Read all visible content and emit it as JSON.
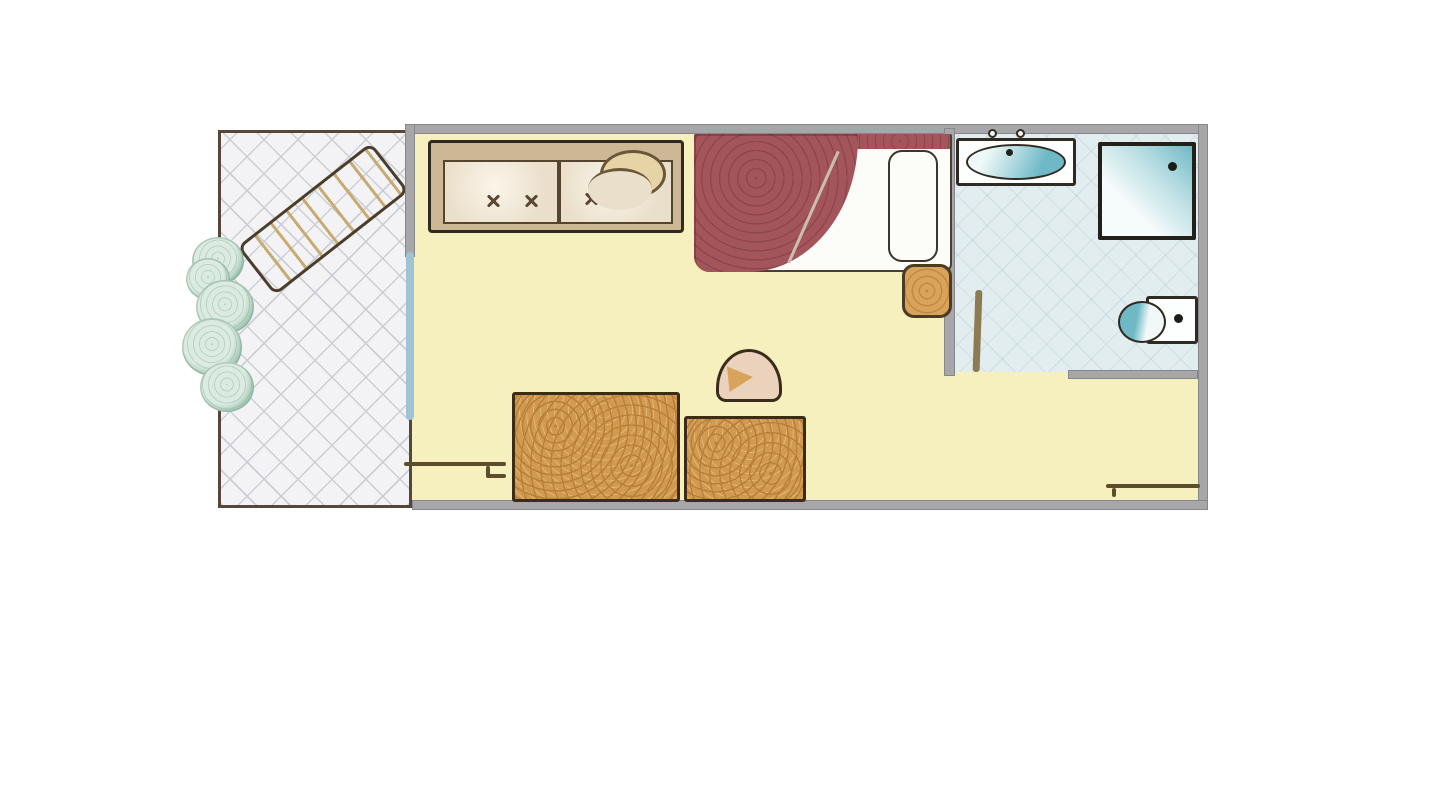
{
  "labels": {
    "plan": "Hotel room floor plan illustration",
    "balcony": "Balcony terrace with tiled floor",
    "lounge_chair": "Sun lounger",
    "plants": "Potted plants along balcony edge",
    "glass_door": "Glass door to balcony",
    "room": "Main room with yellow floor",
    "sofa": "Two-seat sofa with tufted cushions",
    "sofa_throw": "Curved throw pillow on sofa",
    "bed": "Bed with red cover folded back",
    "bed_pillow": "Bed pillow",
    "nightstand": "Wooden nightstand",
    "bathroom": "Bathroom with light blue tiled floor",
    "sink": "Washbasin counter",
    "shower": "Shower enclosure",
    "toilet": "Toilet",
    "bath_door": "Bathroom door leaf",
    "table_large": "Large wooden table",
    "table_small": "Small wooden table",
    "stool": "Stool",
    "wall_top": "Top exterior wall",
    "wall_right": "Right exterior wall",
    "wall_bottom": "Bottom exterior wall",
    "wall_left": "Wall between room and balcony",
    "wall_bath_left": "Wall between bedroom and bathroom",
    "wall_bath_bottom": "Bathroom bottom wall",
    "threshold_left": "Threshold line near table",
    "threshold_right": "Entry threshold line"
  },
  "colors": {
    "page-bg": "#ffffff",
    "wall-gray": "#a7a7a9",
    "wall-dark": "#55483a",
    "balcony-floor": "#f3f3f5",
    "hatch-gray": "#cdcdd5",
    "room-yellow": "#f6efbe",
    "bath-blue": "#e2edf0",
    "sofa-frame": "#cdb795",
    "cushion": "#eadfca",
    "outline-dark": "#2f2a22",
    "bed-red": "#a4555c",
    "bed-red-dark": "#8e454c",
    "white-linen": "#fcfcf9",
    "wood": "#d09a52",
    "wood-grain": "#b97f35",
    "wood-dark": "#3a2c18",
    "nightstand-tan": "#d9a35b",
    "teal": "#6fb9c6",
    "teal-light": "#b7dde2",
    "plant-fill": "#dcebe2",
    "plant-edge": "#9cc2ae",
    "chair-tan": "#e7d4a6",
    "chair-stripe": "#c8ab72",
    "glass-blue": "#9ec4d4",
    "stool-beige": "#ead2bc",
    "stool-wedge": "#d8a35b",
    "line-brown": "#5c4d2c"
  }
}
